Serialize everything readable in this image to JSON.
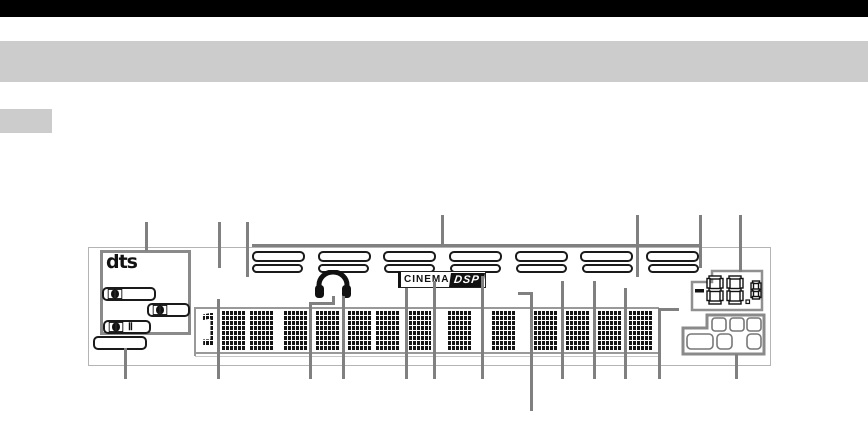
{
  "chrome": {
    "top_bar_color": "#000000",
    "band_color": "#cccccc",
    "side_tab_color": "#cccccc"
  },
  "display": {
    "dts_logo": "dts",
    "dolby_badges": {
      "count": 4,
      "symbol": "dolby-double-d",
      "prologic_marker": "Ⅱ"
    },
    "program_indicators": {
      "rows": 2,
      "windows_per_row": 7
    },
    "cinema_dsp": {
      "cinema": "CINEMA",
      "dsp": "DSP"
    },
    "matrix_display": {
      "leading_digit": "1",
      "block_count": 13
    },
    "volume_display": {
      "value": "-88.8"
    },
    "callout_color": "#808080"
  }
}
